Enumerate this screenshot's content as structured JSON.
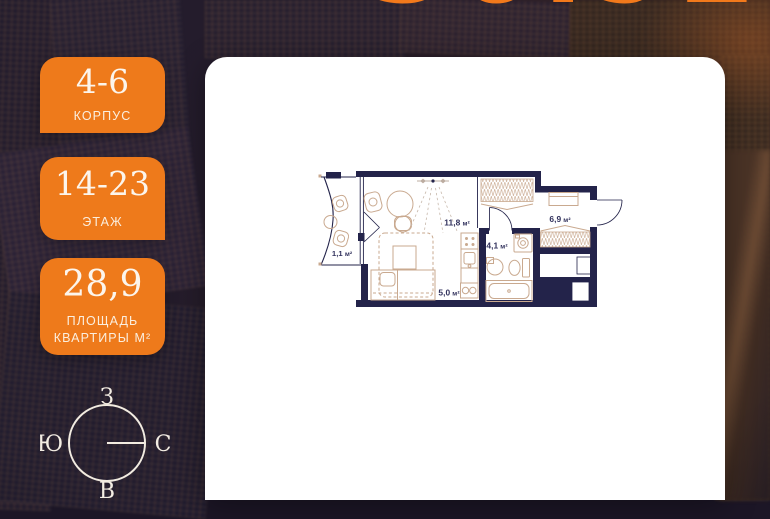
{
  "header": {
    "big_number": "36.92"
  },
  "info_cards": [
    {
      "value": "4-6",
      "label": "КОРПУС"
    },
    {
      "value": "14-23",
      "label": "ЭТАЖ"
    },
    {
      "value": "28,9",
      "label": "ПЛОЩАДЬ КВАРТИРЫ М²"
    }
  ],
  "compass": {
    "top": "З",
    "left": "Ю",
    "right": "С",
    "bottom": "В"
  },
  "floor_plan": {
    "rooms": [
      {
        "name": "living-room",
        "area": "11,8",
        "unit": "м²"
      },
      {
        "name": "hallway",
        "area": "6,9",
        "unit": "м²"
      },
      {
        "name": "bathroom",
        "area": "4,1",
        "unit": "м²"
      },
      {
        "name": "kitchen",
        "area": "5,0",
        "unit": "м²"
      },
      {
        "name": "balcony",
        "area": "1,1",
        "unit": "м²"
      }
    ]
  },
  "colors": {
    "accent_orange": "#ee7a1b",
    "wall_navy": "#23234a",
    "furniture_tan": "#c9a98f"
  }
}
